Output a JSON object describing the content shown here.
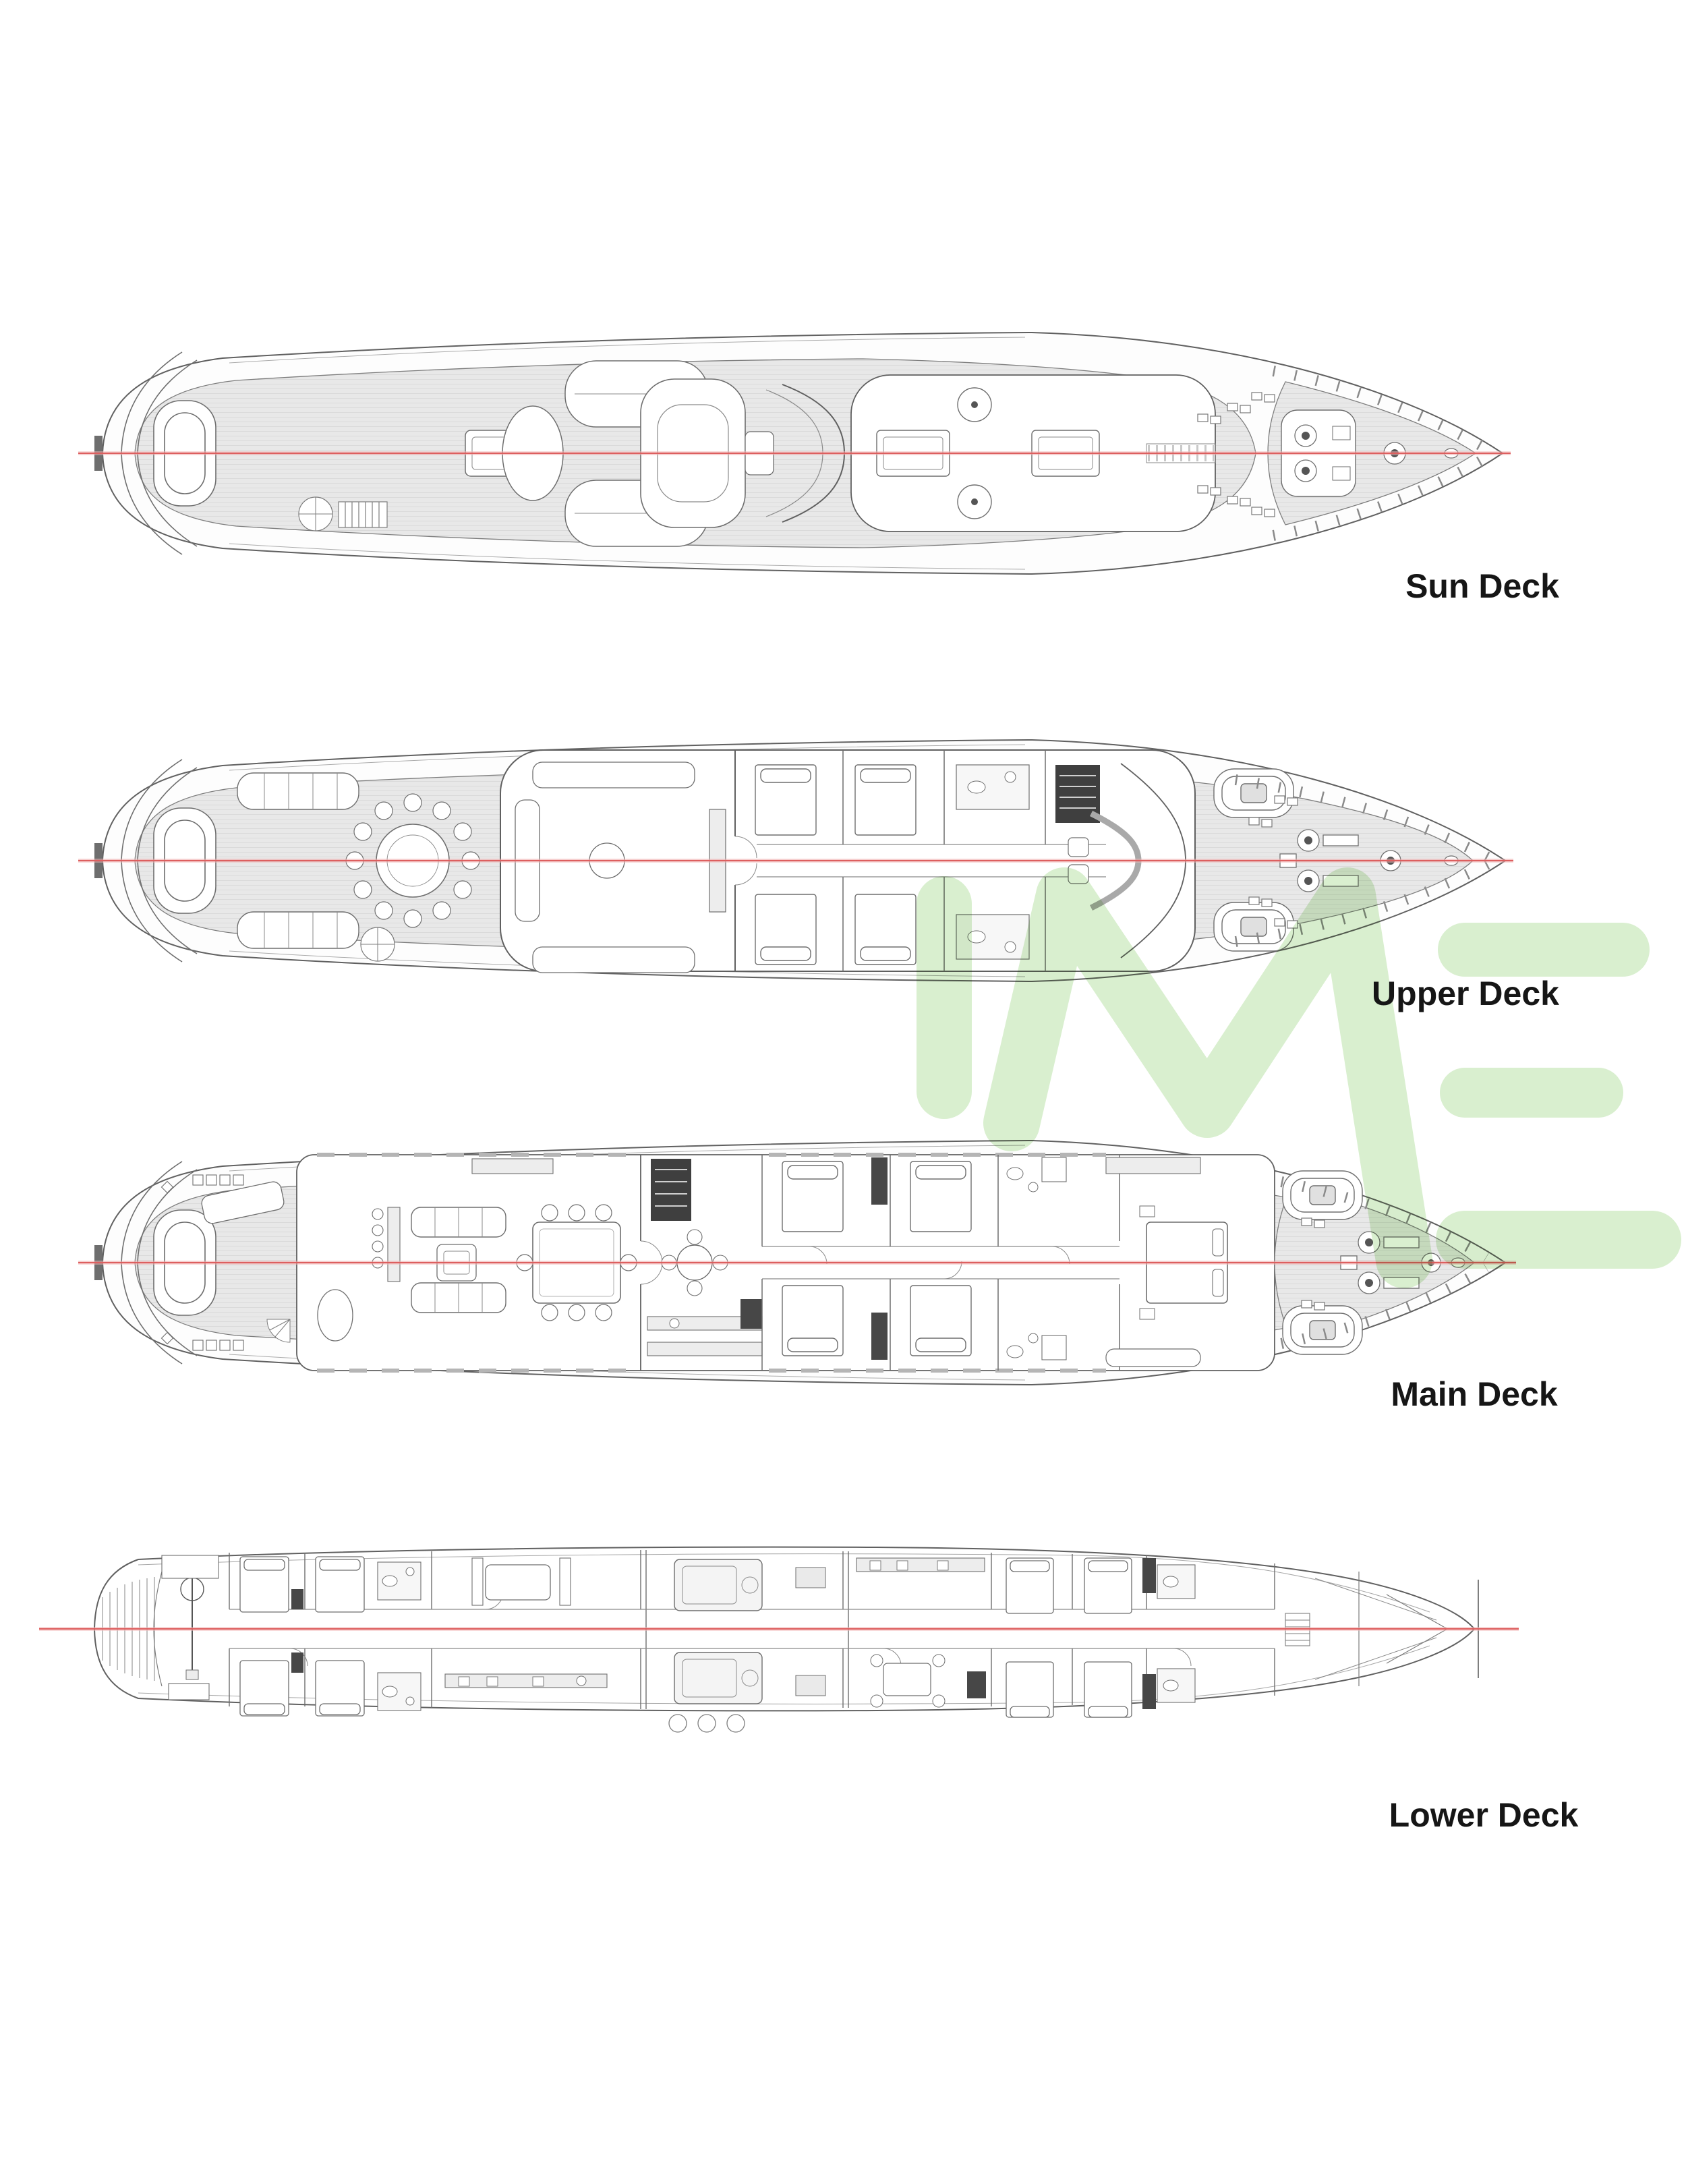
{
  "watermark": {
    "text": "IME",
    "color": "#d9efcf"
  },
  "decks": [
    {
      "id": "sun-deck",
      "label": "Sun Deck"
    },
    {
      "id": "upper-deck",
      "label": "Upper Deck"
    },
    {
      "id": "main-deck",
      "label": "Main Deck"
    },
    {
      "id": "lower-deck",
      "label": "Lower Deck"
    }
  ],
  "colors": {
    "background": "#ffffff",
    "centerline_red": "#dd5f5f",
    "centerline_halo": "#f3b9b9",
    "plan_line": "#606060",
    "deck_teak_fill": "#e8e8e8",
    "interior_fill": "#ffffff",
    "dark_block": "#474747",
    "label_text": "#161616"
  }
}
